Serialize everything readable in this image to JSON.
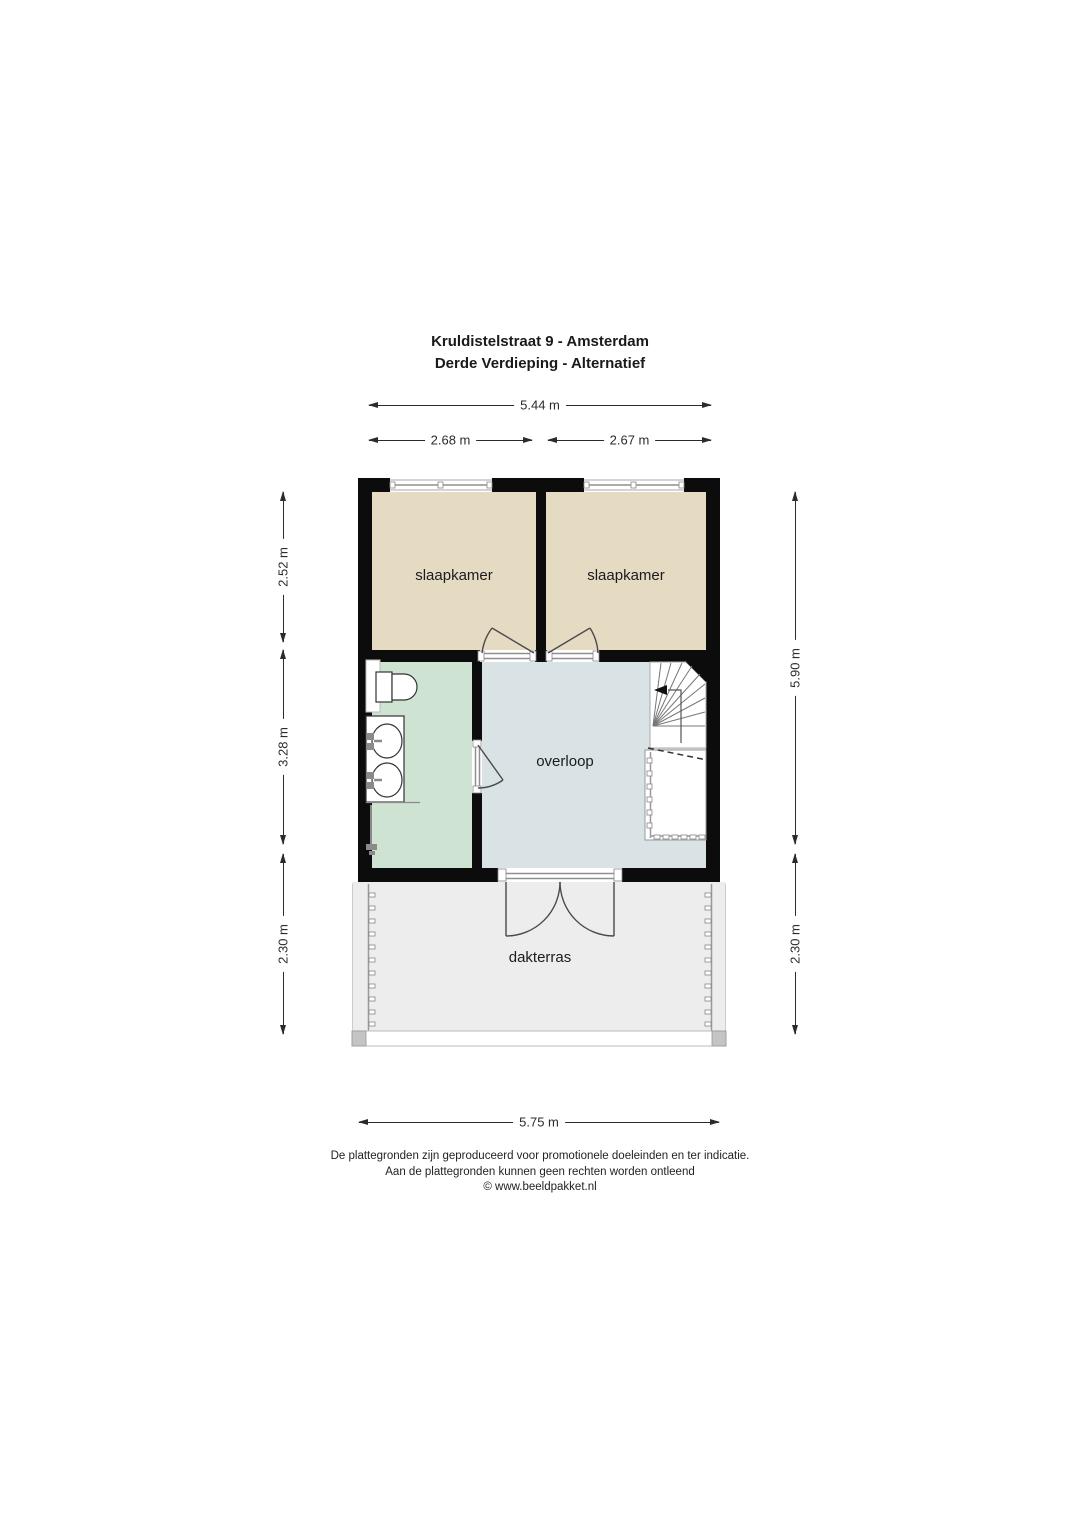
{
  "title": {
    "line1": "Kruldistelstraat 9 - Amsterdam",
    "line2": "Derde Verdieping - Alternatief"
  },
  "rooms": {
    "bedroom_left": "slaapkamer",
    "bedroom_right": "slaapkamer",
    "landing": "overloop",
    "terrace": "dakterras"
  },
  "dimensions": {
    "top_total": "5.44 m",
    "top_left": "2.68 m",
    "top_right": "2.67 m",
    "left_upper": "2.52 m",
    "left_middle": "3.28 m",
    "left_lower": "2.30 m",
    "right_upper": "5.90 m",
    "right_lower": "2.30 m",
    "bottom_total": "5.75 m"
  },
  "footer": {
    "line1": "De plattegronden zijn geproduceerd voor promotionele doeleinden en ter indicatie.",
    "line2": "Aan de plattegronden kunnen geen rechten worden ontleend",
    "line3": "© www.beeldpakket.nl"
  },
  "colors": {
    "wall": "#0c0c0c",
    "bedroom_floor": "#e5dac2",
    "bathroom_floor": "#cfe3d2",
    "landing_floor": "#d9e2e4",
    "terrace_floor": "#ededed",
    "dimension_line": "#2b2b2b",
    "window_frame": "#8f8f8f"
  }
}
